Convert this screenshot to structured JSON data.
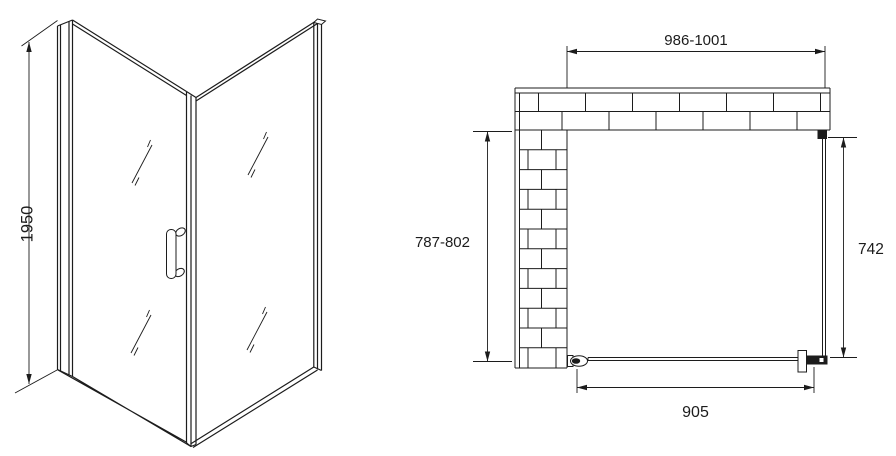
{
  "dimensions": {
    "height": "1950",
    "enclosure_width": "986-1001",
    "enclosure_depth": "787-802",
    "side_panel_width": "742",
    "door_width": "905"
  },
  "colors": {
    "line": "#1c1c1c",
    "background": "#ffffff"
  }
}
